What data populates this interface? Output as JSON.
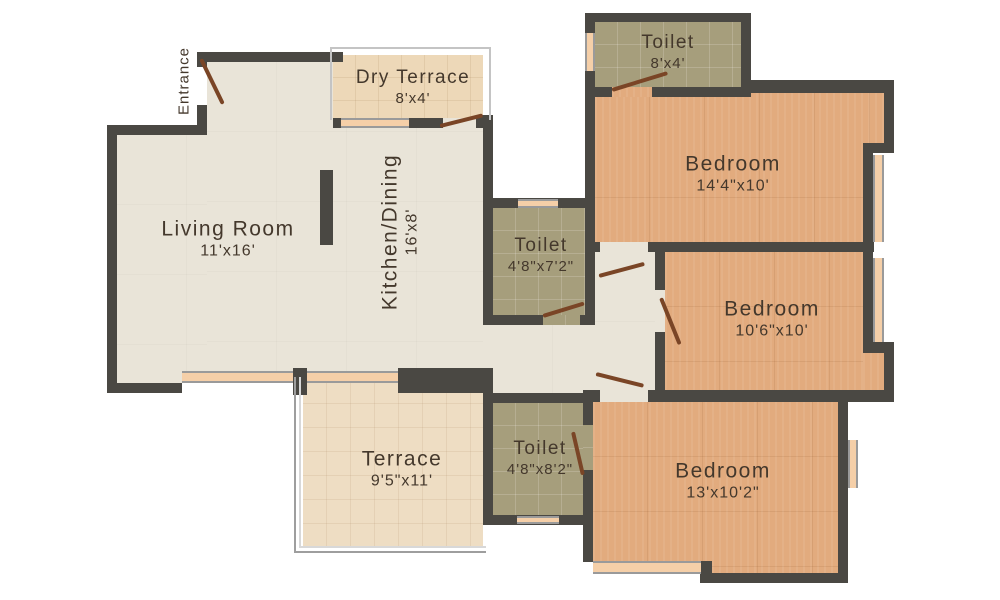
{
  "plan_title": "3 BHK Apartment Floor Plan",
  "rooms": {
    "entrance": {
      "name": "Entrance"
    },
    "living": {
      "name": "Living Room",
      "dims": "11'x16'"
    },
    "kitchen": {
      "name": "Kitchen/Dining",
      "dims": "16'x8'"
    },
    "dry_terrace": {
      "name": "Dry Terrace",
      "dims": "8'x4'"
    },
    "toilet_top": {
      "name": "Toilet",
      "dims": "8'x4'"
    },
    "bedroom_top": {
      "name": "Bedroom",
      "dims": "14'4\"x10'"
    },
    "toilet_mid": {
      "name": "Toilet",
      "dims": "4'8\"x7'2\""
    },
    "bedroom_mid": {
      "name": "Bedroom",
      "dims": "10'6\"x10'"
    },
    "terrace": {
      "name": "Terrace",
      "dims": "9'5\"x11'"
    },
    "toilet_bottom": {
      "name": "Toilet",
      "dims": "4'8\"x8'2\""
    },
    "bedroom_bottom": {
      "name": "Bedroom",
      "dims": "13'x10'2\""
    }
  },
  "colors": {
    "wall": "#4a4843",
    "floor_living": "#e9e4d8",
    "floor_bedroom": "#e2ab7e",
    "floor_toilet": "#a69e7c",
    "floor_dry_terrace": "#edd8b8",
    "floor_terrace": "#eeddc3",
    "window": "#f5cfa8",
    "door_leaf": "#7a4526",
    "label_text": "#44382c",
    "background": "#ffffff"
  }
}
